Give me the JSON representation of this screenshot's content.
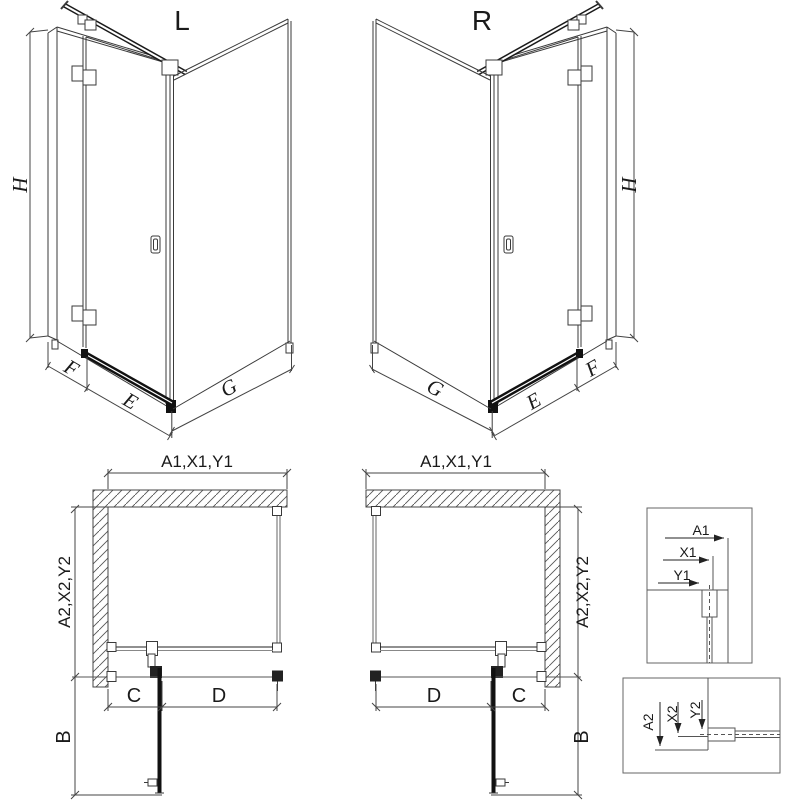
{
  "title_labels": {
    "left_view": "L",
    "right_view": "R"
  },
  "dimension_labels": {
    "height": "H",
    "fixed_panel_width": "F",
    "door_width": "E",
    "side_wall_width": "G",
    "plan_width": "A1,X1,Y1",
    "plan_depth": "A2,X2,Y2",
    "fixed_segment": "C",
    "door_segment": "D",
    "door_opening": "B",
    "detail_top": {
      "a": "A1",
      "x": "X1",
      "y": "Y1"
    },
    "detail_bottom": {
      "a": "A2",
      "x": "X2",
      "y": "Y2"
    }
  },
  "colors": {
    "background": "#ffffff",
    "main_line": "#3a3a3a",
    "thin_line": "#6b6b6b",
    "dark_fill": "#111111",
    "text": "#1a1a1a"
  }
}
